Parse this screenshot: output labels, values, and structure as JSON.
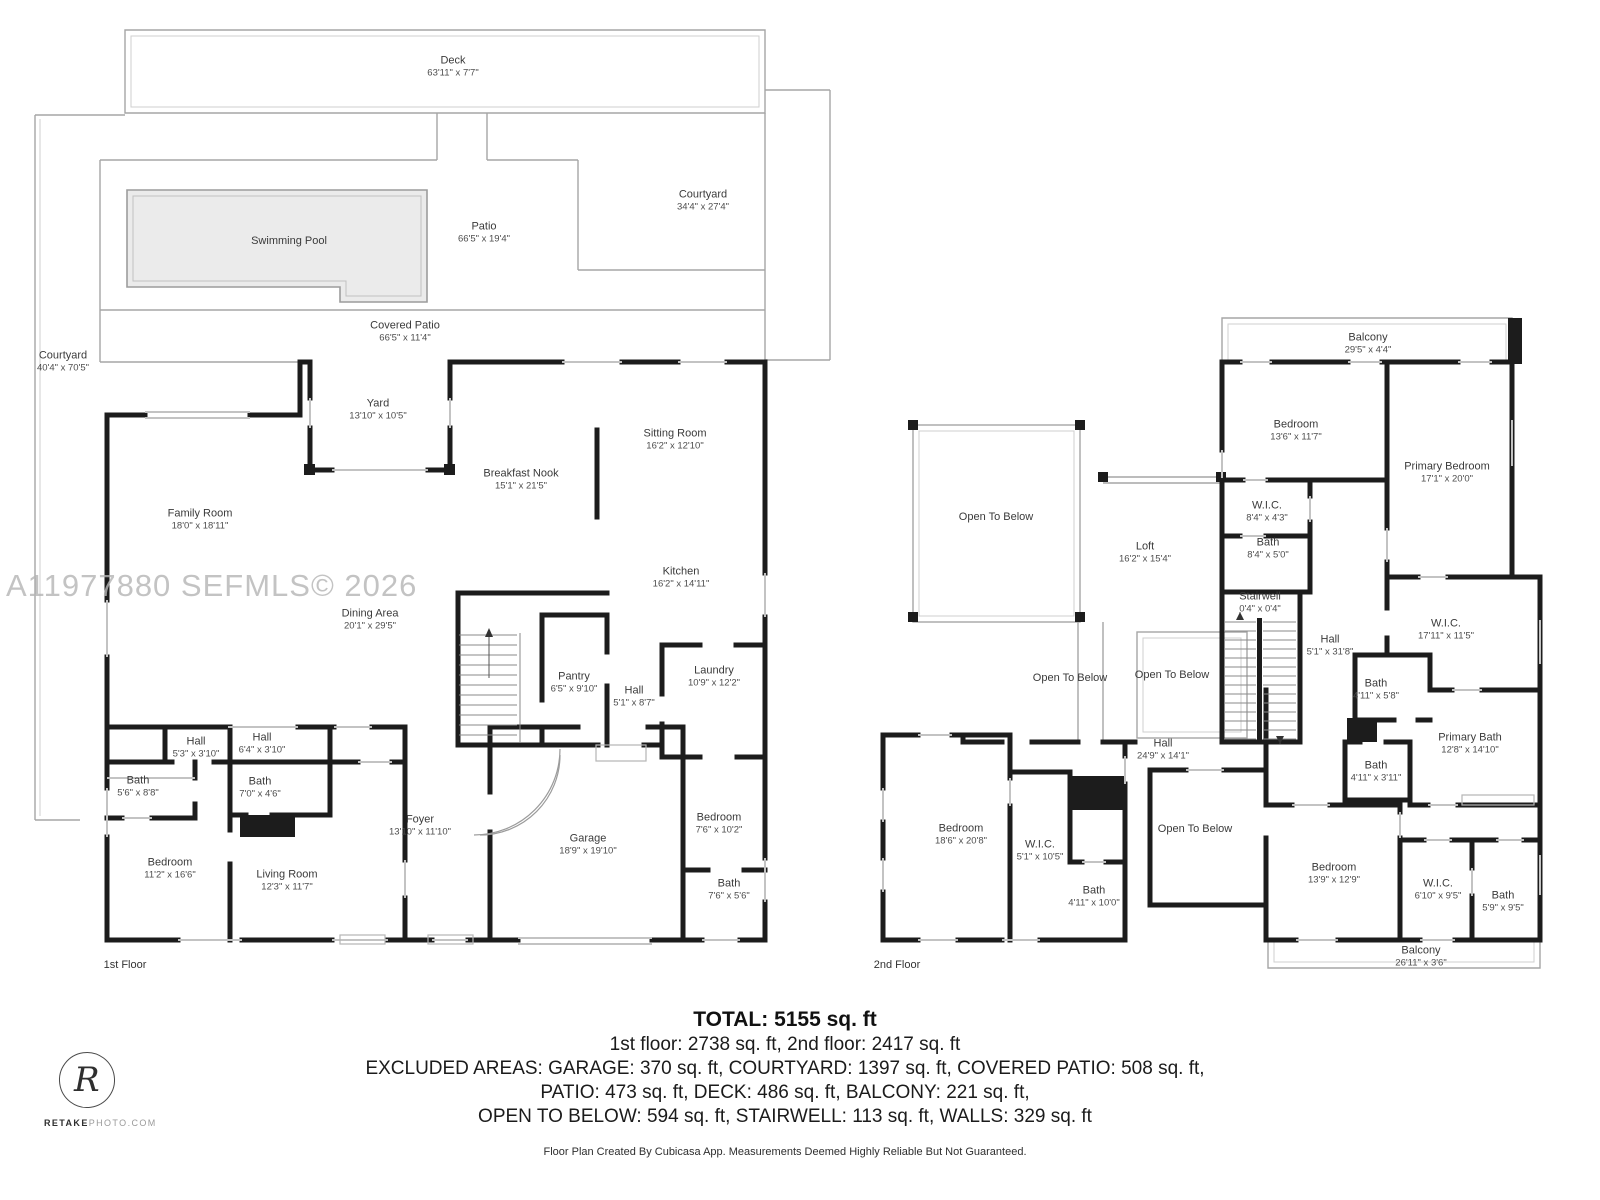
{
  "watermark": "A11977880  SEFMLS© 2026",
  "logo": {
    "monogram": "R",
    "brand_bold": "RETAKE",
    "brand_rest": "PHOTO.COM"
  },
  "colors": {
    "wall": "#1c1c1c",
    "outdoor_line": "#a6a6a6",
    "window_line": "#c3c3c3",
    "pool_fill": "#ebebeb"
  },
  "floors": {
    "first": {
      "label": "1st Floor",
      "rooms": [
        {
          "name": "Deck",
          "dims": "63'11\" x 7'7\""
        },
        {
          "name": "Courtyard",
          "dims": "34'4\" x 27'4\""
        },
        {
          "name": "Patio",
          "dims": "66'5\" x 19'4\""
        },
        {
          "name": "Swimming Pool",
          "dims": ""
        },
        {
          "name": "Covered Patio",
          "dims": "66'5\" x 11'4\""
        },
        {
          "name": "Courtyard",
          "dims": "40'4\" x 70'5\""
        },
        {
          "name": "Yard",
          "dims": "13'10\" x 10'5\""
        },
        {
          "name": "Sitting Room",
          "dims": "16'2\" x 12'10\""
        },
        {
          "name": "Breakfast Nook",
          "dims": "15'1\" x 21'5\""
        },
        {
          "name": "Family Room",
          "dims": "18'0\" x 18'11\""
        },
        {
          "name": "Kitchen",
          "dims": "16'2\" x 14'11\""
        },
        {
          "name": "Dining Area",
          "dims": "20'1\" x 29'5\""
        },
        {
          "name": "Pantry",
          "dims": "6'5\" x 9'10\""
        },
        {
          "name": "Hall",
          "dims": "5'1\" x 8'7\""
        },
        {
          "name": "Laundry",
          "dims": "10'9\" x 12'2\""
        },
        {
          "name": "Hall",
          "dims": "5'3\" x 3'10\""
        },
        {
          "name": "Hall",
          "dims": "6'4\" x 3'10\""
        },
        {
          "name": "Bath",
          "dims": "5'6\" x 8'8\""
        },
        {
          "name": "Bath",
          "dims": "7'0\" x 4'6\""
        },
        {
          "name": "Bedroom",
          "dims": "11'2\" x 16'6\""
        },
        {
          "name": "Living Room",
          "dims": "12'3\" x 11'7\""
        },
        {
          "name": "Foyer",
          "dims": "13'10\" x 11'10\""
        },
        {
          "name": "Garage",
          "dims": "18'9\" x 19'10\""
        },
        {
          "name": "Bedroom",
          "dims": "7'6\" x 10'2\""
        },
        {
          "name": "Bath",
          "dims": "7'6\" x 5'6\""
        }
      ]
    },
    "second": {
      "label": "2nd Floor",
      "rooms": [
        {
          "name": "Balcony",
          "dims": "29'5\" x 4'4\""
        },
        {
          "name": "Bedroom",
          "dims": "13'6\" x 11'7\""
        },
        {
          "name": "Primary Bedroom",
          "dims": "17'1\" x 20'0\""
        },
        {
          "name": "Open To Below",
          "dims": ""
        },
        {
          "name": "Loft",
          "dims": "16'2\" x 15'4\""
        },
        {
          "name": "W.I.C.",
          "dims": "8'4\" x 4'3\""
        },
        {
          "name": "Bath",
          "dims": "8'4\" x 5'0\""
        },
        {
          "name": "Stairwell",
          "dims": "0'4\" x 0'4\""
        },
        {
          "name": "Hall",
          "dims": "5'1\" x 31'8\""
        },
        {
          "name": "W.I.C.",
          "dims": "17'11\" x 11'5\""
        },
        {
          "name": "Open To Below",
          "dims": ""
        },
        {
          "name": "Open To Below",
          "dims": ""
        },
        {
          "name": "Bath",
          "dims": "4'11\" x 5'8\""
        },
        {
          "name": "Primary Bath",
          "dims": "12'8\" x 14'10\""
        },
        {
          "name": "Bath",
          "dims": "4'11\" x 3'11\""
        },
        {
          "name": "Hall",
          "dims": "24'9\" x 14'1\""
        },
        {
          "name": "Open To Below",
          "dims": ""
        },
        {
          "name": "Bedroom",
          "dims": "18'6\" x 20'8\""
        },
        {
          "name": "W.I.C.",
          "dims": "5'1\" x 10'5\""
        },
        {
          "name": "Bath",
          "dims": "4'11\" x 10'0\""
        },
        {
          "name": "Bedroom",
          "dims": "13'9\" x 12'9\""
        },
        {
          "name": "W.I.C.",
          "dims": "6'10\" x 9'5\""
        },
        {
          "name": "Bath",
          "dims": "5'9\" x 9'5\""
        },
        {
          "name": "Balcony",
          "dims": "26'11\" x 3'6\""
        }
      ]
    }
  },
  "summary": {
    "total": "TOTAL: 5155 sq. ft",
    "line1": "1st floor: 2738 sq. ft, 2nd floor: 2417 sq. ft",
    "excluded1": "EXCLUDED AREAS: GARAGE: 370 sq. ft, COURTYARD: 1397 sq. ft, COVERED PATIO: 508 sq. ft,",
    "excluded2": "PATIO: 473 sq. ft, DECK: 486 sq. ft, BALCONY: 221 sq. ft,",
    "excluded3": "OPEN TO BELOW: 594 sq. ft, STAIRWELL: 113 sq. ft, WALLS: 329 sq. ft",
    "footer": "Floor Plan Created By Cubicasa App. Measurements Deemed Highly Reliable But Not Guaranteed."
  }
}
